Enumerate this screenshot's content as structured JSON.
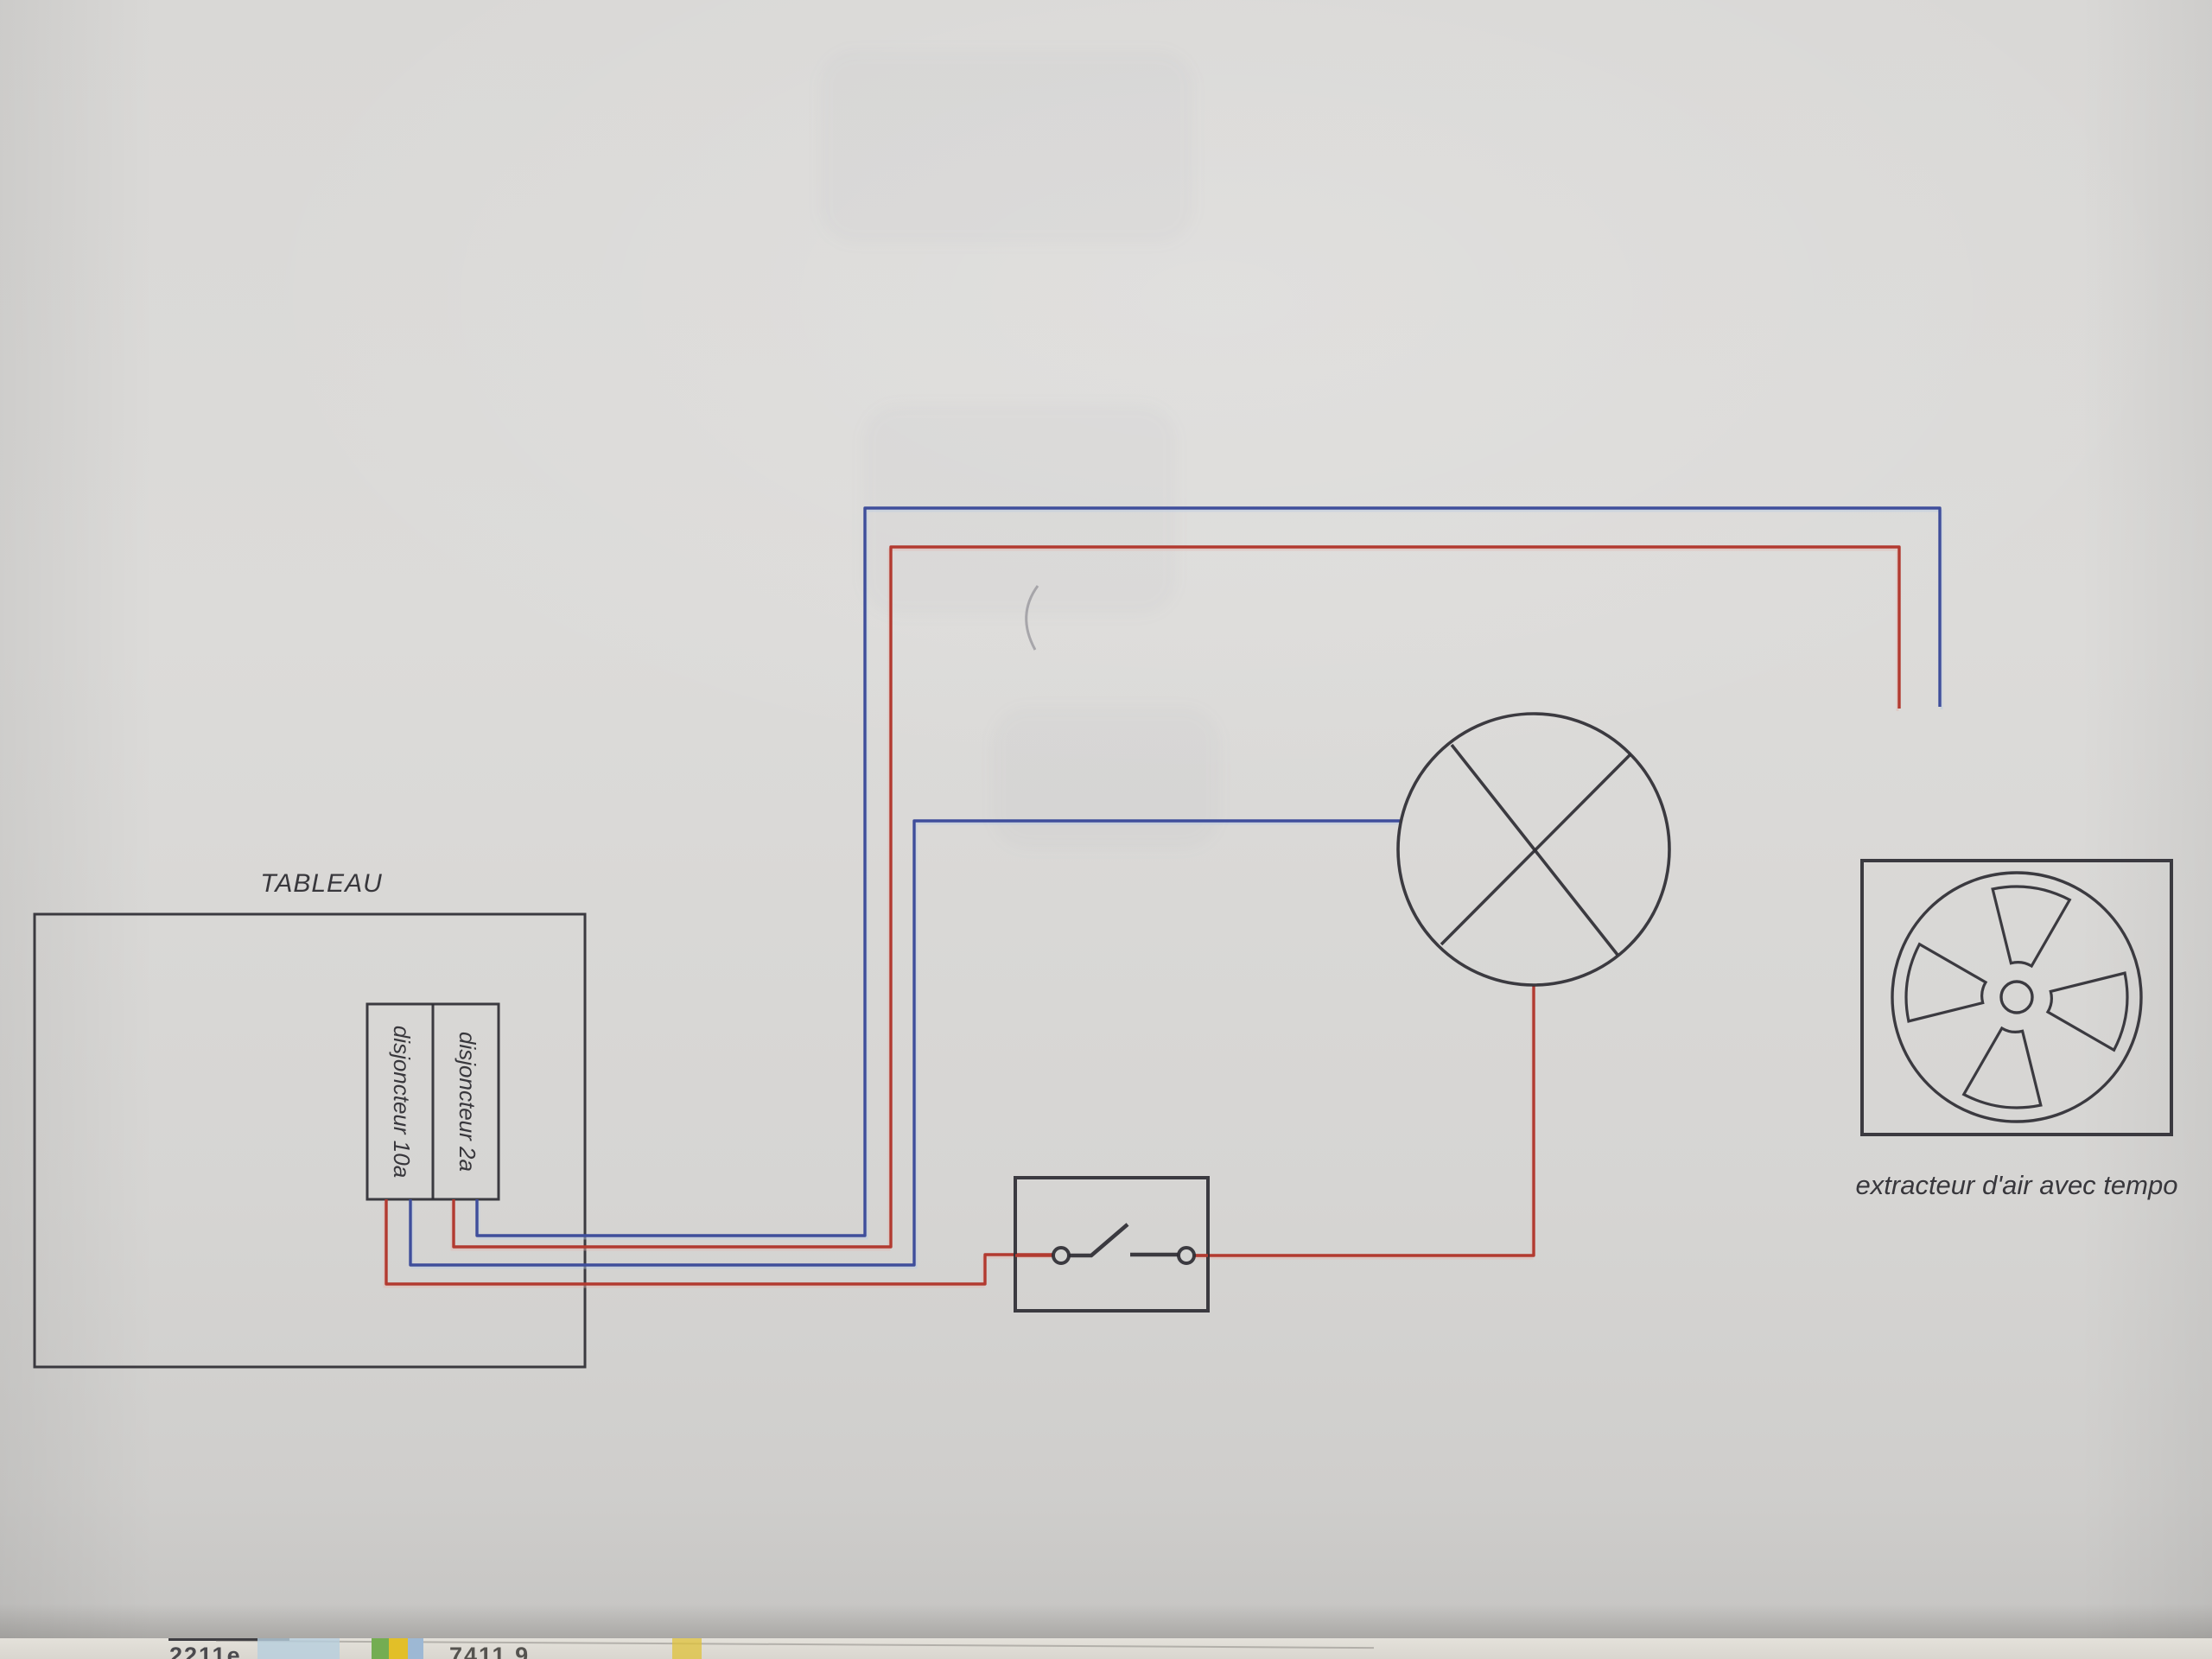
{
  "photo": {
    "panel_title": "TABLEAU",
    "breaker_left_label": "disjoncteur 10a",
    "breaker_right_label": "disjoncteur 2a",
    "extractor_caption": "extracteur d'air avec tempo",
    "colors": {
      "live_wire": "#b23a30",
      "neutral_wire": "#3f4e9b",
      "ink": "#2e2d33"
    },
    "underlay_fragments": {
      "left_text": "2211e",
      "right_text": "7411.9"
    }
  }
}
